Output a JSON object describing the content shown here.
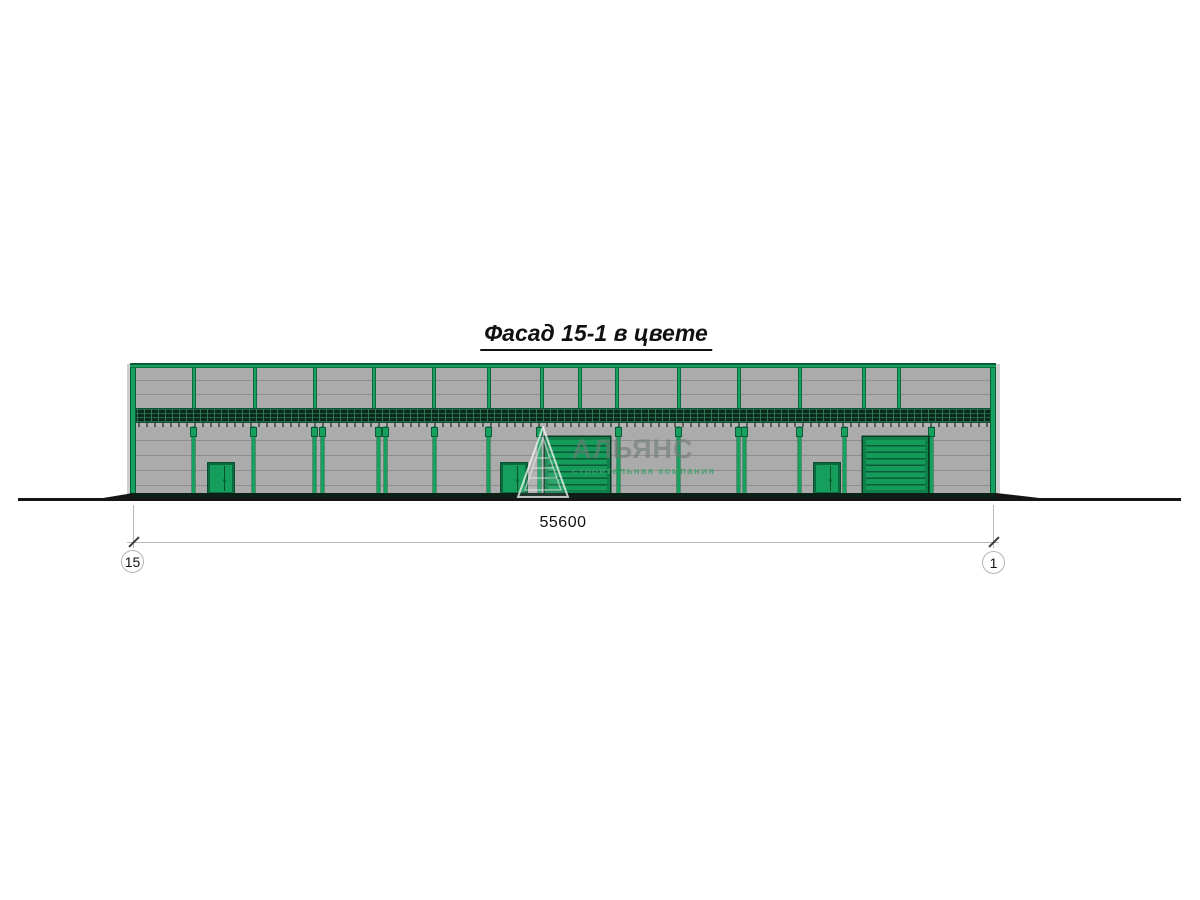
{
  "title": "Фасад 15-1 в цвете",
  "dimension": {
    "value": "55600"
  },
  "axes": {
    "left_label": "15",
    "right_label": "1"
  },
  "watermark": {
    "name": "АЛЬЯНС",
    "tagline": "строительная компания"
  },
  "colors": {
    "frame_green": "#17a15f",
    "panel_gray": "#ababab",
    "band_dark_green": "#0b2a1e",
    "ground_black": "#151515",
    "dim_gray": "#b8b8b8"
  }
}
